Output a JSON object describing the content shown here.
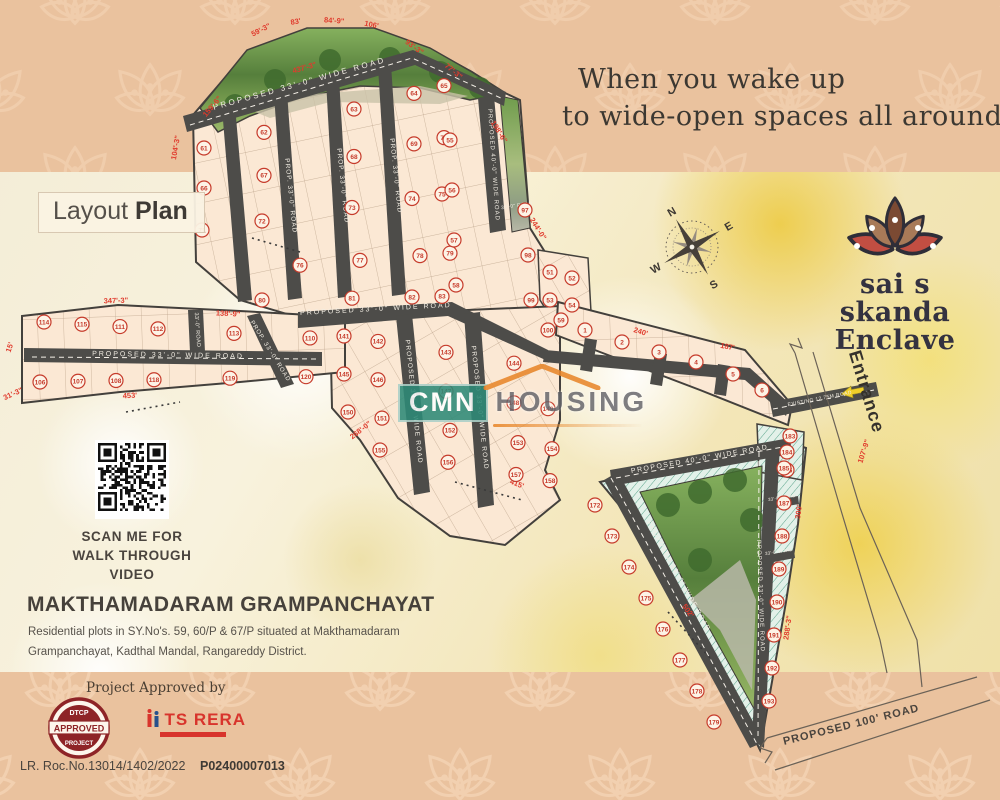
{
  "banner": {
    "line1": "When you wake up",
    "line2": "to wide-open spaces all around you"
  },
  "layout_plan": {
    "label_regular": "Layout",
    "label_bold": "Plan"
  },
  "logo": {
    "name_line1": "sai s skanda",
    "name_line2": "Enclave"
  },
  "compass": {
    "n": "N",
    "e": "E",
    "s": "S",
    "w": "W"
  },
  "entrance_label": "Entrance",
  "watermark": {
    "line1": "CMN",
    "line2": "HOUSING"
  },
  "qr": {
    "caption_line1": "SCAN ME FOR",
    "caption_line2": "WALK THROUGH VIDEO"
  },
  "location": {
    "heading": "MAKTHAMADARAM GRAMPANCHAYAT",
    "description_line1": "Residential plots in SY.No's. 59, 60/P & 67/P situated at Makthamadaram",
    "description_line2": "Grampanchayat, Kadthal Mandal, Rangareddy District."
  },
  "approvals": {
    "heading": "Project Approved by",
    "dtcp_badge": {
      "top": "DTCP",
      "middle": "APPROVED",
      "bottom": "PROJECT"
    },
    "ts_rera": "TS RERA",
    "lr_number": "LR. Roc.No.13014/1402/2022",
    "rera_number": "P02400007013"
  },
  "map": {
    "road_labels": [
      "PROPOSED 33'-0\" WIDE ROAD",
      "PROP. 33'-0\" ROAD",
      "PROP. 33'-0\" ROAD",
      "PROP. 33'-0\" ROAD",
      "PROPOSED 40'-0\" WIDE ROAD",
      "33'-0\" ROAD",
      "PROPOSED 33'-0\" WIDE ROAD",
      "PROPOSED 33'-0\" WIDE ROAD",
      "33'-0\" ROAD",
      "PROP. 33'-0\" ROAD",
      "PROPOSED 33'-0\" WIDE ROAD",
      "PROPOSED 33'-0\" WIDE ROAD",
      "PROPOSED 40'-0\" WIDE ROAD",
      "PROPOSED 33'-0\" WIDE ROAD",
      "PROPOSED 33'-0\" WIDE ROAD",
      "33'-0\" ROAD",
      "33'-0\" ROAD",
      "EXISTING 12.75M ROAD",
      "PROPOSED 100' ROAD"
    ],
    "dimensions": [
      "159'-6\"",
      "59'-3\"",
      "83'",
      "84'-9\"",
      "106'",
      "93'-3\"",
      "77'-3\"",
      "437'-3\"",
      "104'-3\"",
      "198'-6\"",
      "244'-0\"",
      "347'-3\"",
      "138'-9\"",
      "453'",
      "15'",
      "31'-3\"",
      "268'-0\"",
      "415'",
      "240'",
      "187'",
      "502'",
      "288'-3\"",
      "300'",
      "107'-9\""
    ],
    "plot_numbers": {
      "top_block": [
        61,
        62,
        63,
        64,
        65,
        66,
        67,
        68,
        69,
        70,
        71,
        72,
        73,
        74,
        75,
        76,
        77,
        78,
        79,
        80,
        81,
        82,
        83,
        84,
        85,
        86,
        87,
        88,
        89,
        90,
        91,
        92,
        93,
        94,
        95
      ],
      "east_cluster": [
        55,
        56,
        57,
        58,
        97,
        98,
        99,
        100
      ],
      "ear": [
        51,
        52,
        53,
        54,
        59
      ],
      "mid_block": [
        141,
        142,
        143,
        144,
        145,
        146,
        147,
        148,
        149,
        150,
        151,
        152,
        153,
        154,
        155,
        156,
        157,
        158,
        159,
        160
      ],
      "left_arm": [
        114,
        115,
        111,
        112,
        113,
        110,
        106,
        107,
        108,
        118,
        119,
        120
      ],
      "arm": [
        1,
        2,
        3,
        4,
        5,
        6
      ],
      "hypo_strip": [
        172,
        173,
        174,
        175,
        176,
        177,
        178,
        179
      ],
      "right_strip": [
        186,
        187,
        188,
        189,
        190,
        191,
        192,
        193
      ],
      "entrance_strip": [
        183,
        184,
        185
      ]
    }
  },
  "colors": {
    "band_peach": "#eac29e",
    "lotus_outline": "#f2d0b0",
    "road": "#4d4c49",
    "plot_fill": "#fbe8d4",
    "teal": "#4f9d85",
    "dim_red": "#e03b2d",
    "text_dark": "#3e3a35",
    "logo_brown": "#7b4a33",
    "logo_tan": "#a87a58",
    "logo_red": "#c24e42",
    "watermark_teal": "#2e8a77",
    "arrow_yellow": "#f0cf2a",
    "badge_maroon": "#8e2427",
    "rera_red": "#d8342c"
  }
}
